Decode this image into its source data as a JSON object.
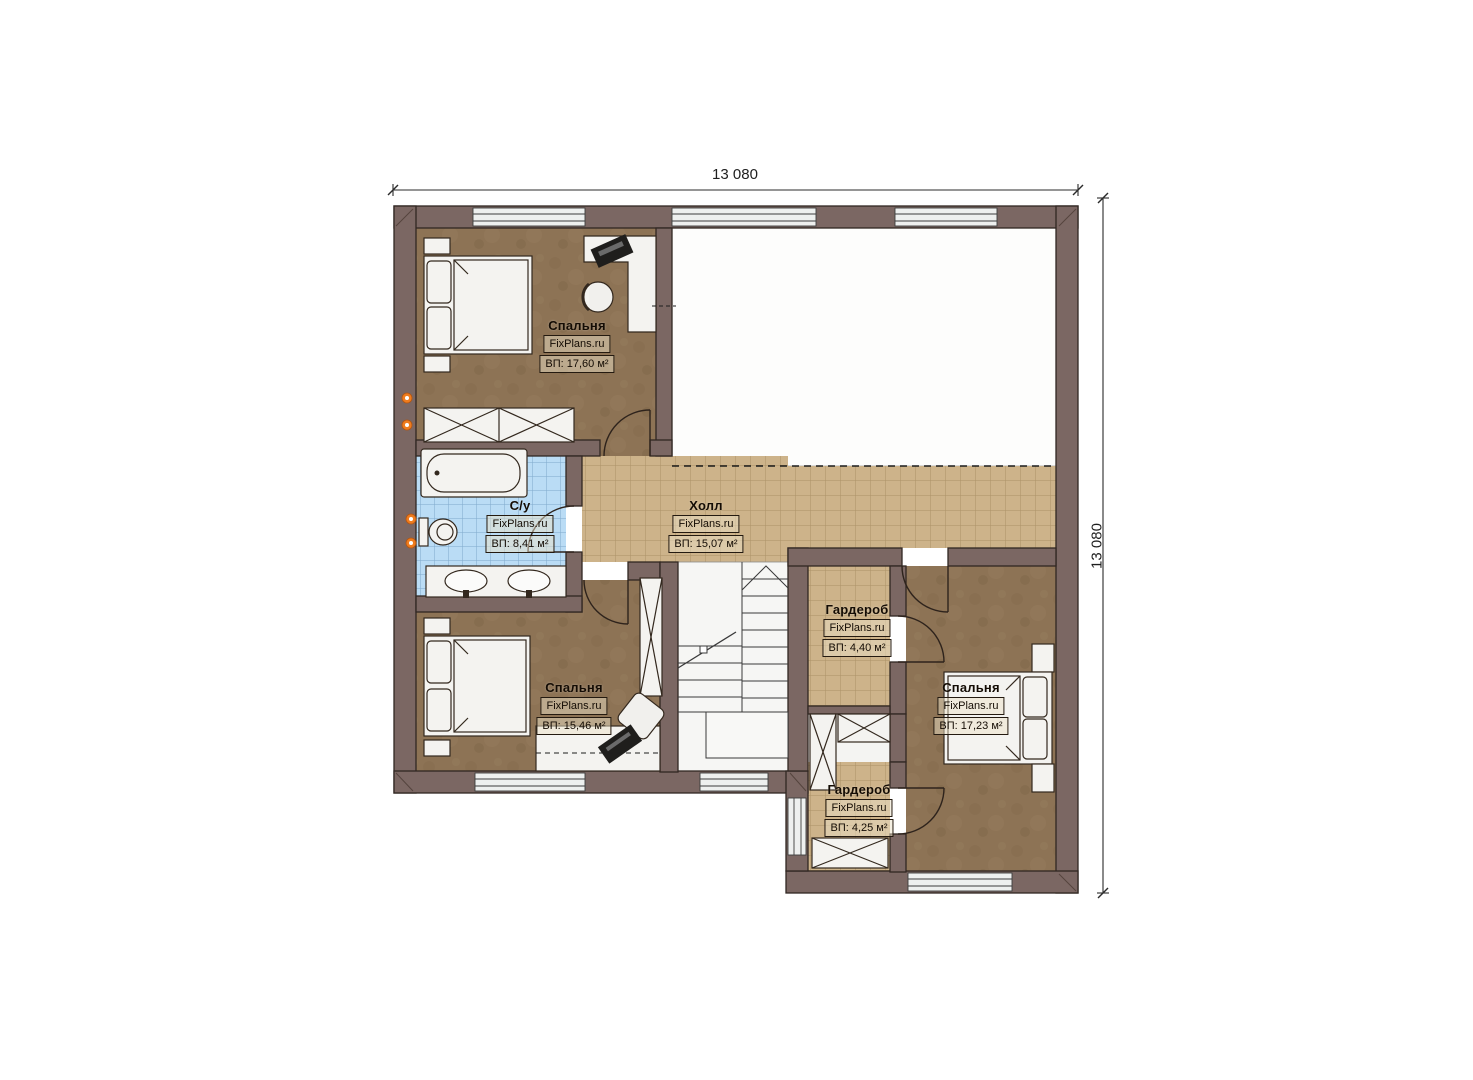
{
  "page": {
    "background_color": "#ffffff"
  },
  "plan": {
    "dimension_top": "13 080",
    "dimension_right": "13 080",
    "rooms": [
      {
        "id": "bedroom-1",
        "name": "Спальня",
        "brand": "FixPlans.ru",
        "area": "ВП: 17,60 м²"
      },
      {
        "id": "bathroom",
        "name": "С/у",
        "brand": "FixPlans.ru",
        "area": "ВП: 8,41 м²"
      },
      {
        "id": "hall",
        "name": "Холл",
        "brand": "FixPlans.ru",
        "area": "ВП: 15,07 м²"
      },
      {
        "id": "wardrobe-1",
        "name": "Гардероб",
        "brand": "FixPlans.ru",
        "area": "ВП: 4,40 м²"
      },
      {
        "id": "bedroom-2",
        "name": "Спальня",
        "brand": "FixPlans.ru",
        "area": "ВП: 15,46 м²"
      },
      {
        "id": "bedroom-3",
        "name": "Спальня",
        "brand": "FixPlans.ru",
        "area": "ВП: 17,23 м²"
      },
      {
        "id": "wardrobe-2",
        "name": "Гардероб",
        "brand": "FixPlans.ru",
        "area": "ВП: 4,25 м²"
      }
    ],
    "colors": {
      "wall": "#7b6763",
      "bedroom_floor": "#8d7355",
      "tile_floor": "#cdb38a",
      "bathroom_tile": "#badcf5",
      "heating_riser": "#ef7c1e"
    }
  }
}
